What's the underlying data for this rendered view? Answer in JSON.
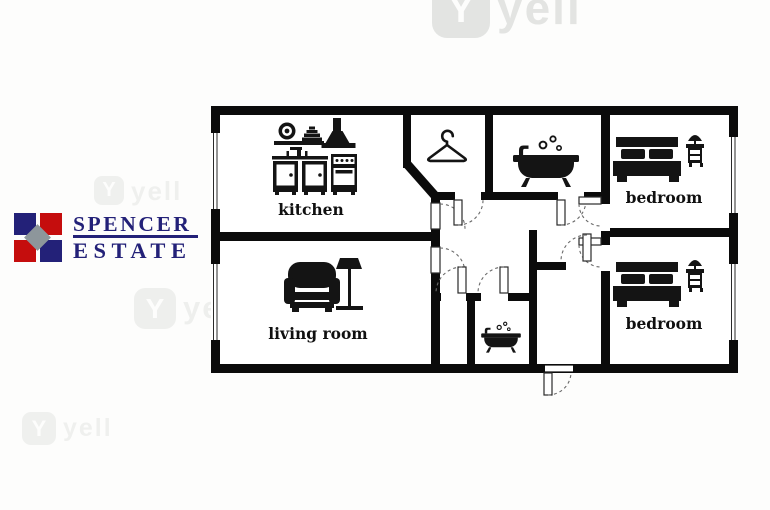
{
  "brand": {
    "name": "Spencer Estate",
    "line1": "SPENCER",
    "line2": "ESTATE",
    "navy": "#232178",
    "red": "#c50d0d",
    "gray": "#8d969b"
  },
  "watermark": {
    "glyph": "Y",
    "word": "yell"
  },
  "floor_plan": {
    "wall_color": "#0b0b0b",
    "background": "#ffffff",
    "rooms": [
      {
        "id": "kitchen",
        "label": "kitchen",
        "icons": [
          "dishes-icon",
          "cooker-hood-icon",
          "kitchen-cabinets-icon",
          "sink-faucet-icon",
          "stove-icon"
        ]
      },
      {
        "id": "living-room",
        "label": "living room",
        "icons": [
          "armchair-icon",
          "floor-lamp-icon"
        ]
      },
      {
        "id": "bedroom-top",
        "label": "bedroom",
        "icons": [
          "double-bed-icon",
          "nightstand-lamp-icon"
        ]
      },
      {
        "id": "bedroom-bottom",
        "label": "bedroom",
        "icons": [
          "double-bed-icon",
          "nightstand-lamp-icon"
        ]
      },
      {
        "id": "wardrobe",
        "label": "",
        "icons": [
          "hanger-icon"
        ]
      },
      {
        "id": "bathroom",
        "label": "",
        "icons": [
          "bathtub-icon"
        ]
      },
      {
        "id": "wc",
        "label": "",
        "icons": [
          "bathtub-icon"
        ]
      }
    ]
  }
}
